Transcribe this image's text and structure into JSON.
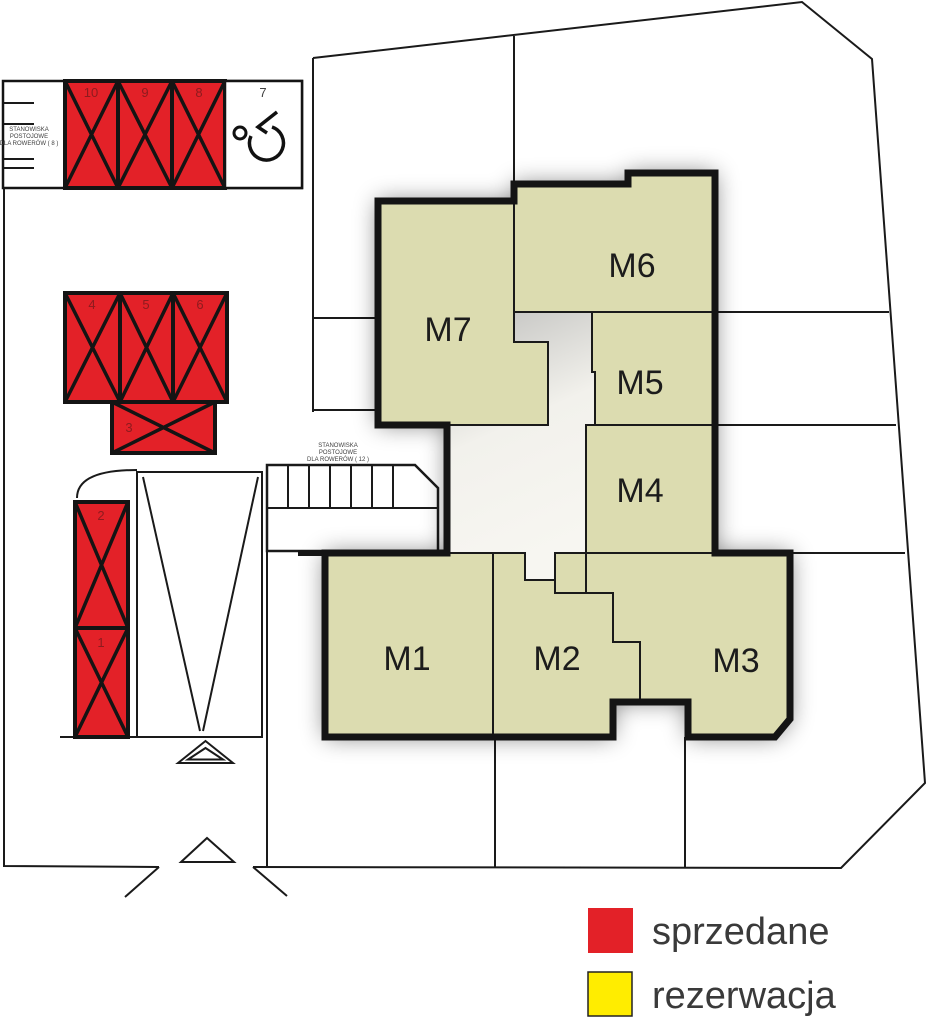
{
  "title": "site-plan-apartment-picker",
  "colors": {
    "apartment_fill": "#dcdcb0",
    "sold": "#e32128",
    "reserved": "#ffed00",
    "outline": "#141414"
  },
  "apartments": [
    {
      "label": "M1"
    },
    {
      "label": "M2"
    },
    {
      "label": "M3"
    },
    {
      "label": "M4"
    },
    {
      "label": "M5"
    },
    {
      "label": "M6"
    },
    {
      "label": "M7"
    }
  ],
  "parking_spaces": [
    {
      "number": "1",
      "status": "sprzedane"
    },
    {
      "number": "2",
      "status": "sprzedane"
    },
    {
      "number": "3",
      "status": "sprzedane"
    },
    {
      "number": "4",
      "status": "sprzedane"
    },
    {
      "number": "5",
      "status": "sprzedane"
    },
    {
      "number": "6",
      "status": "sprzedane"
    },
    {
      "number": "7",
      "type": "disabled"
    },
    {
      "number": "8",
      "status": "sprzedane"
    },
    {
      "number": "9",
      "status": "sprzedane"
    },
    {
      "number": "10",
      "status": "sprzedane"
    }
  ],
  "bike_stands_small": {
    "line1": "STANOWISKA",
    "line2": "POSTOJOWE",
    "line3": "DLA ROWERÓW ( 8 )"
  },
  "bike_stands_large": {
    "line1": "STANOWISKA",
    "line2": "POSTOJOWE",
    "line3": "DLA ROWERÓW ( 12 )"
  },
  "legend": {
    "sold_label": "sprzedane",
    "reserved_label": "rezerwacja"
  }
}
